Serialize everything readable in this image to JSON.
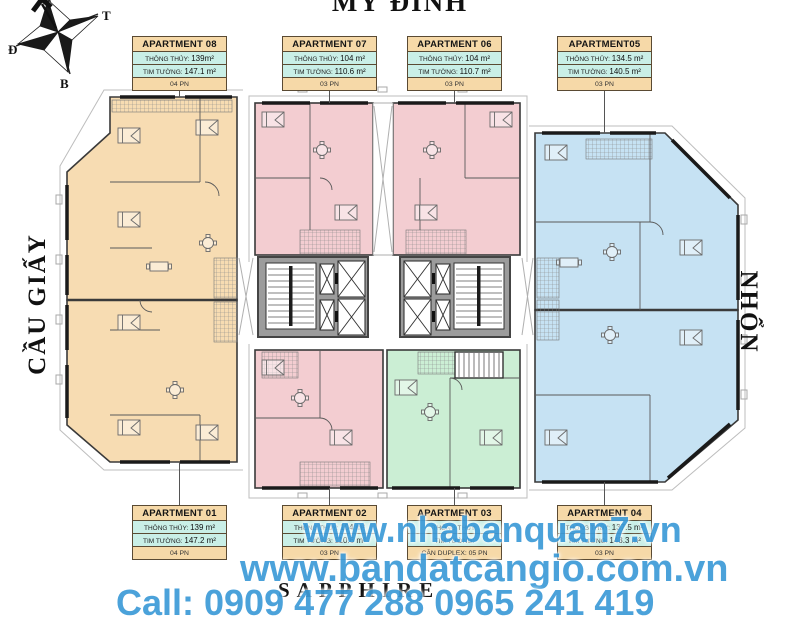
{
  "title": "MỸ ĐÌNH",
  "side_labels": {
    "left": "CẦU GIẤY",
    "right": "NHỔN"
  },
  "compass": {
    "top": "N",
    "right": "T",
    "left": "Đ",
    "bottom": "B"
  },
  "field_labels": {
    "thong_thuy": "THÔNG THỦY:",
    "tim_tuong": "TIM TƯỜNG:"
  },
  "apartments": [
    {
      "id": "08",
      "name": "APARTMENT 08",
      "thong_thuy": "139m²",
      "tim_tuong": "147.1 m²",
      "bedrooms": "04 PN",
      "color_key": "unit_orange",
      "position": "top-left"
    },
    {
      "id": "07",
      "name": "APARTMENT 07",
      "thong_thuy": "104 m²",
      "tim_tuong": "110.6 m²",
      "bedrooms": "03 PN",
      "color_key": "unit_pink",
      "position": "top-center-left"
    },
    {
      "id": "06",
      "name": "APARTMENT 06",
      "thong_thuy": "104 m²",
      "tim_tuong": "110.7 m²",
      "bedrooms": "03 PN",
      "color_key": "unit_pink",
      "position": "top-center-right"
    },
    {
      "id": "05",
      "name": "APARTMENT05",
      "thong_thuy": "134.5 m²",
      "tim_tuong": "140.5 m²",
      "bedrooms": "03 PN",
      "color_key": "unit_blue",
      "position": "top-right"
    },
    {
      "id": "01",
      "name": "APARTMENT 01",
      "thong_thuy": "139 m²",
      "tim_tuong": "147.2 m²",
      "bedrooms": "04 PN",
      "color_key": "unit_orange",
      "position": "bottom-left"
    },
    {
      "id": "02",
      "name": "APARTMENT 02",
      "thong_thuy": "104 m²",
      "tim_tuong": "110.6 m²",
      "bedrooms": "03 PN",
      "color_key": "unit_pink",
      "position": "bottom-center-left"
    },
    {
      "id": "03",
      "name": "APARTMENT 03",
      "thong_thuy": "",
      "tim_tuong": "",
      "bedrooms": "CĂN DUPLEX: 05 PN",
      "color_key": "unit_green",
      "position": "bottom-center-right"
    },
    {
      "id": "04",
      "name": "APARTMENT 04",
      "thong_thuy": "137.5 m²",
      "tim_tuong": "143.3 m²",
      "bedrooms": "03 PN",
      "color_key": "unit_blue",
      "position": "bottom-right"
    }
  ],
  "watermark": {
    "line1": "www.nhabanquan7.vn",
    "line2": "www.bandatcangio.com.vn",
    "line3": "Call: 0909 477 288  0965 241 419"
  },
  "building_label": "SAPPHIRE",
  "colors": {
    "box_header_bg": "#f6d9a8",
    "box_value_bg": "#c9efe7",
    "box_border": "#5a4a33",
    "unit_orange": "#f7dcb2",
    "unit_pink": "#f3cdd1",
    "unit_blue": "#c6e2f3",
    "unit_green": "#cbeed4",
    "core_gray": "#9c9c9c",
    "wall": "#3a3a3a",
    "watermark_blue": "#3e9bd8"
  }
}
